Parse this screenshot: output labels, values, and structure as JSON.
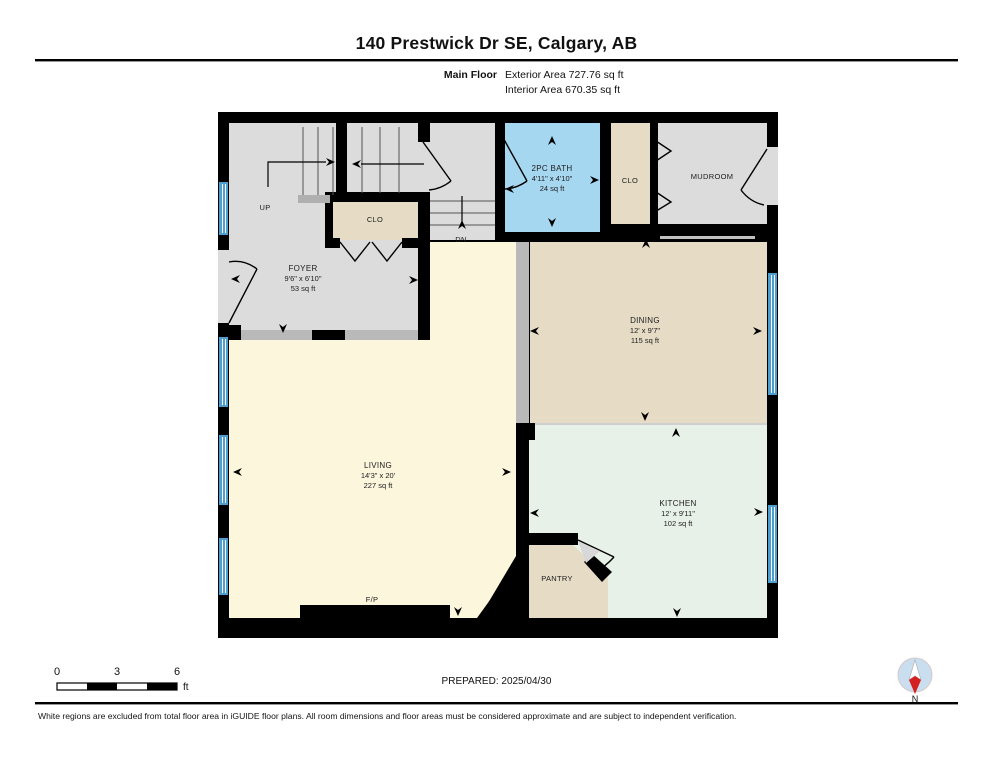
{
  "header": {
    "title": "140 Prestwick Dr SE, Calgary, AB",
    "floor_label": "Main Floor",
    "exterior_area": "Exterior Area 727.76 sq ft",
    "interior_area": "Interior Area 670.35 sq ft"
  },
  "plan": {
    "rooms": [
      {
        "id": "foyer",
        "name": "FOYER",
        "dims": "9'6\" x 6'10\"",
        "area": "53 sq ft"
      },
      {
        "id": "bath",
        "name": "2PC BATH",
        "dims": "4'11\" x 4'10\"",
        "area": "24 sq ft"
      },
      {
        "id": "closet-foyer",
        "name": "CLO"
      },
      {
        "id": "closet-mudroom",
        "name": "CLO"
      },
      {
        "id": "mudroom",
        "name": "MUDROOM"
      },
      {
        "id": "dining",
        "name": "DINING",
        "dims": "12' x 9'7\"",
        "area": "115 sq ft"
      },
      {
        "id": "living",
        "name": "LIVING",
        "dims": "14'3\" x 20'",
        "area": "227 sq ft"
      },
      {
        "id": "kitchen",
        "name": "KITCHEN",
        "dims": "12' x 9'11\"",
        "area": "102 sq ft"
      },
      {
        "id": "pantry",
        "name": "PANTRY"
      }
    ],
    "annotations": {
      "up": "UP",
      "down": "DN",
      "fireplace": "F/P"
    }
  },
  "scale_bar": {
    "ticks": [
      "0",
      "3",
      "6"
    ],
    "unit": "ft"
  },
  "footer": {
    "prepared": "PREPARED: 2025/04/30",
    "north": "N",
    "disclaimer": "White regions are excluded from total floor area in iGUIDE floor plans. All room dimensions and floor areas must be considered approximate and are subject to independent verification."
  },
  "colors": {
    "wall": "#000000",
    "room_gray": "#dcdcdc",
    "beige": "#e6dcc6",
    "bath_blue": "#a6d7f1",
    "living_yellow": "#fcf6dd",
    "kitchen_green": "#e8f1e8",
    "window_blue": "#4d9fd1",
    "half_wall_gray": "#b9b9b9",
    "sill_gray": "#c0c0c0",
    "compass_fill": "#c9dff0",
    "compass_red": "#d42020"
  }
}
